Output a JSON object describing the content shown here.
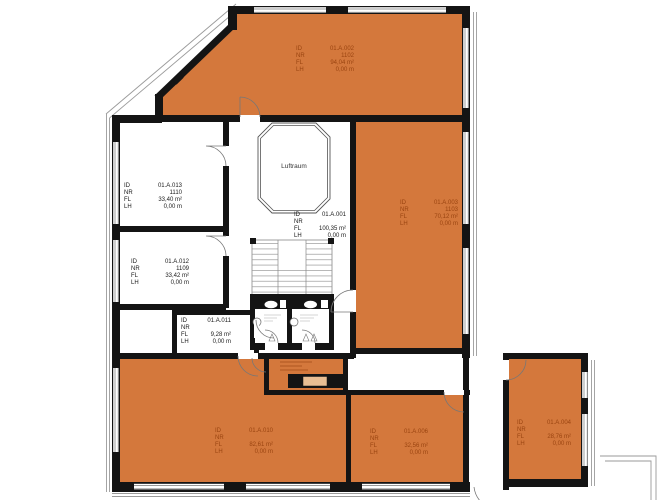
{
  "plan": {
    "field_labels": {
      "id": "ID",
      "nr": "NR",
      "fl": "FL",
      "lh": "LH"
    },
    "atrium_label": "Luftraum",
    "colors": {
      "room_highlight": "#D4783C",
      "elevator_car": "#E9BE93",
      "label_on_orange": "#9A4410",
      "label_on_white": "#1A1A1A",
      "wall": "#141414",
      "thin_line": "#8A8A8A"
    },
    "rooms": [
      {
        "id": "01.A.002",
        "nr": "1102",
        "fl": "94,04 m²",
        "lh": "0,00 m",
        "highlighted": true
      },
      {
        "id": "01.A.003",
        "nr": "1103",
        "fl": "70,12 m²",
        "lh": "0,00 m",
        "highlighted": true
      },
      {
        "id": "01.A.013",
        "nr": "1110",
        "fl": "33,40 m²",
        "lh": "0,00 m",
        "highlighted": false
      },
      {
        "id": "01.A.012",
        "nr": "1109",
        "fl": "33,42 m²",
        "lh": "0,00 m",
        "highlighted": false
      },
      {
        "id": "01.A.011",
        "nr": "",
        "fl": "9,28 m²",
        "lh": "0,00 m",
        "highlighted": false
      },
      {
        "id": "01.A.001",
        "nr": "",
        "fl": "100,35 m²",
        "lh": "0,00 m",
        "highlighted": false
      },
      {
        "id": "01.A.010",
        "nr": "",
        "fl": "82,61 m²",
        "lh": "0,00 m",
        "highlighted": true
      },
      {
        "id": "01.A.006",
        "nr": "",
        "fl": "32,56 m²",
        "lh": "0,00 m",
        "highlighted": true
      },
      {
        "id": "01.A.004",
        "nr": "",
        "fl": "28,76 m²",
        "lh": "0,00 m",
        "highlighted": true
      }
    ]
  }
}
